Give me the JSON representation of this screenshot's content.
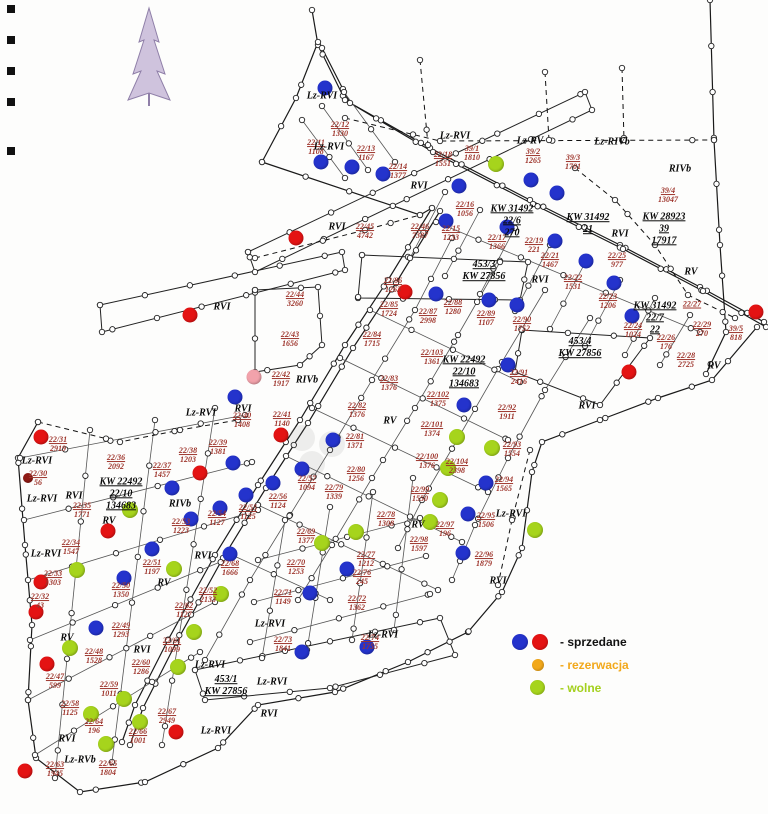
{
  "map": {
    "title": "plan sprzedazy dzialek",
    "dot_colors": {
      "blue": "#2433cc",
      "red": "#e41313",
      "darkred": "#8f1a14",
      "green": "#a6d41c",
      "orange": "#f2a81a",
      "pink": "#f2a2ab"
    },
    "dot_sizes": {
      "blue": 15,
      "red": 15,
      "darkred": 10,
      "green": 16,
      "orange": 11,
      "pink": 15
    },
    "plots": [
      {
        "n": "22/11",
        "a": "1108",
        "x": 316,
        "y": 148
      },
      {
        "n": "22/12",
        "a": "1330",
        "x": 340,
        "y": 130
      },
      {
        "n": "22/13",
        "a": "1167",
        "x": 366,
        "y": 154
      },
      {
        "n": "22/14",
        "a": "1377",
        "x": 398,
        "y": 172
      },
      {
        "n": "22/18",
        "a": "1551",
        "x": 443,
        "y": 160
      },
      {
        "n": "39/1",
        "a": "1810",
        "x": 472,
        "y": 154
      },
      {
        "n": "39/2",
        "a": "1265",
        "x": 533,
        "y": 157
      },
      {
        "n": "39/3",
        "a": "1701",
        "x": 573,
        "y": 163
      },
      {
        "n": "39/4",
        "a": "13047",
        "x": 668,
        "y": 196
      },
      {
        "n": "22/16",
        "a": "1056",
        "x": 465,
        "y": 210
      },
      {
        "n": "22/15",
        "a": "1233",
        "x": 451,
        "y": 234
      },
      {
        "n": "22/46",
        "a": "7387",
        "x": 420,
        "y": 232
      },
      {
        "n": "22/17",
        "a": "1366",
        "x": 497,
        "y": 243
      },
      {
        "n": "22/19",
        "a": "221",
        "x": 534,
        "y": 246
      },
      {
        "n": "22/21",
        "a": "1467",
        "x": 550,
        "y": 261
      },
      {
        "n": "22/22",
        "a": "1531",
        "x": 573,
        "y": 283
      },
      {
        "n": "22/25",
        "a": "977",
        "x": 617,
        "y": 261
      },
      {
        "n": "22/23",
        "a": "1206",
        "x": 608,
        "y": 302
      },
      {
        "n": "22/24",
        "a": "1024",
        "x": 633,
        "y": 331
      },
      {
        "n": "22/26",
        "a": "176",
        "x": 666,
        "y": 343
      },
      {
        "n": "22/27",
        "a": "",
        "x": 692,
        "y": 305
      },
      {
        "n": "22/29",
        "a": "270",
        "x": 702,
        "y": 330
      },
      {
        "n": "39/5",
        "a": "818",
        "x": 736,
        "y": 334
      },
      {
        "n": "22/28",
        "a": "2725",
        "x": 686,
        "y": 361
      },
      {
        "n": "22/45",
        "a": "4742",
        "x": 365,
        "y": 232
      },
      {
        "n": "22/44",
        "a": "3260",
        "x": 295,
        "y": 300
      },
      {
        "n": "22/43",
        "a": "1656",
        "x": 290,
        "y": 340
      },
      {
        "n": "22/42",
        "a": "1917",
        "x": 281,
        "y": 380
      },
      {
        "n": "22/41",
        "a": "1140",
        "x": 282,
        "y": 420
      },
      {
        "n": "22/40",
        "a": "1408",
        "x": 242,
        "y": 421
      },
      {
        "n": "22/39",
        "a": "1381",
        "x": 218,
        "y": 448
      },
      {
        "n": "22/38",
        "a": "1203",
        "x": 188,
        "y": 456
      },
      {
        "n": "22/37",
        "a": "1457",
        "x": 162,
        "y": 471
      },
      {
        "n": "22/36",
        "a": "2092",
        "x": 116,
        "y": 463
      },
      {
        "n": "22/31",
        "a": "2919",
        "x": 58,
        "y": 445
      },
      {
        "n": "22/30",
        "a": "56",
        "x": 38,
        "y": 479
      },
      {
        "n": "22/35",
        "a": "1771",
        "x": 82,
        "y": 511
      },
      {
        "n": "22/34",
        "a": "1547",
        "x": 71,
        "y": 548
      },
      {
        "n": "22/33",
        "a": "1303",
        "x": 53,
        "y": 579
      },
      {
        "n": "22/32",
        "a": "43",
        "x": 40,
        "y": 602
      },
      {
        "n": "22/51",
        "a": "1197",
        "x": 152,
        "y": 568
      },
      {
        "n": "22/50",
        "a": "1350",
        "x": 121,
        "y": 591
      },
      {
        "n": "22/68",
        "a": "1666",
        "x": 230,
        "y": 569
      },
      {
        "n": "22/52",
        "a": "2133",
        "x": 208,
        "y": 596
      },
      {
        "n": "22/62",
        "a": "1127",
        "x": 184,
        "y": 611
      },
      {
        "n": "22/49",
        "a": "1293",
        "x": 121,
        "y": 631
      },
      {
        "n": "22/61",
        "a": "1099",
        "x": 172,
        "y": 646
      },
      {
        "n": "22/48",
        "a": "1528",
        "x": 94,
        "y": 657
      },
      {
        "n": "22/60",
        "a": "1286",
        "x": 141,
        "y": 668
      },
      {
        "n": "22/47",
        "a": "599",
        "x": 55,
        "y": 682
      },
      {
        "n": "22/59",
        "a": "1011",
        "x": 109,
        "y": 690
      },
      {
        "n": "22/58",
        "a": "1125",
        "x": 70,
        "y": 709
      },
      {
        "n": "22/64",
        "a": "196",
        "x": 94,
        "y": 727
      },
      {
        "n": "22/63",
        "a": "1945",
        "x": 55,
        "y": 770
      },
      {
        "n": "22/65",
        "a": "1804",
        "x": 108,
        "y": 769
      },
      {
        "n": "22/66",
        "a": "1001",
        "x": 138,
        "y": 737
      },
      {
        "n": "22/67",
        "a": "2949",
        "x": 167,
        "y": 717
      },
      {
        "n": "22/57",
        "a": "1094",
        "x": 307,
        "y": 484
      },
      {
        "n": "22/56",
        "a": "1124",
        "x": 278,
        "y": 502
      },
      {
        "n": "22/55",
        "a": "1125",
        "x": 248,
        "y": 513
      },
      {
        "n": "22/54",
        "a": "1127",
        "x": 217,
        "y": 519
      },
      {
        "n": "22/53",
        "a": "1223",
        "x": 181,
        "y": 527
      },
      {
        "n": "22/81",
        "a": "1371",
        "x": 355,
        "y": 442
      },
      {
        "n": "22/80",
        "a": "1256",
        "x": 356,
        "y": 475
      },
      {
        "n": "22/79",
        "a": "1339",
        "x": 334,
        "y": 493
      },
      {
        "n": "22/78",
        "a": "1308",
        "x": 386,
        "y": 520
      },
      {
        "n": "22/69",
        "a": "1377",
        "x": 306,
        "y": 537
      },
      {
        "n": "22/70",
        "a": "1253",
        "x": 296,
        "y": 568
      },
      {
        "n": "22/77",
        "a": "1212",
        "x": 366,
        "y": 560
      },
      {
        "n": "22/76",
        "a": "245",
        "x": 362,
        "y": 578
      },
      {
        "n": "22/71",
        "a": "1149",
        "x": 283,
        "y": 598
      },
      {
        "n": "22/72",
        "a": "1362",
        "x": 357,
        "y": 604
      },
      {
        "n": "22/73",
        "a": "1841",
        "x": 283,
        "y": 645
      },
      {
        "n": "22/74",
        "a": "1755",
        "x": 370,
        "y": 643
      },
      {
        "n": "22/98",
        "a": "1597",
        "x": 419,
        "y": 545
      },
      {
        "n": "22/99",
        "a": "1550",
        "x": 420,
        "y": 495
      },
      {
        "n": "22/100",
        "a": "1376",
        "x": 427,
        "y": 462
      },
      {
        "n": "22/101",
        "a": "1374",
        "x": 432,
        "y": 430
      },
      {
        "n": "22/102",
        "a": "1375",
        "x": 438,
        "y": 400
      },
      {
        "n": "22/103",
        "a": "1361",
        "x": 432,
        "y": 358
      },
      {
        "n": "22/104",
        "a": "2398",
        "x": 457,
        "y": 467
      },
      {
        "n": "22/97",
        "a": "196",
        "x": 445,
        "y": 530
      },
      {
        "n": "22/91",
        "a": "2416",
        "x": 519,
        "y": 378
      },
      {
        "n": "22/92",
        "a": "1911",
        "x": 507,
        "y": 413
      },
      {
        "n": "22/93",
        "a": "1554",
        "x": 512,
        "y": 450
      },
      {
        "n": "22/94",
        "a": "1565",
        "x": 504,
        "y": 485
      },
      {
        "n": "22/95",
        "a": "1506",
        "x": 486,
        "y": 521
      },
      {
        "n": "22/96",
        "a": "1879",
        "x": 484,
        "y": 560
      },
      {
        "n": "22/90",
        "a": "1752",
        "x": 522,
        "y": 325
      },
      {
        "n": "22/89",
        "a": "1107",
        "x": 486,
        "y": 319
      },
      {
        "n": "22/88",
        "a": "1280",
        "x": 453,
        "y": 308
      },
      {
        "n": "22/87",
        "a": "2998",
        "x": 428,
        "y": 317
      },
      {
        "n": "22/86",
        "a": "1263",
        "x": 393,
        "y": 286
      },
      {
        "n": "22/85",
        "a": "1724",
        "x": 389,
        "y": 310
      },
      {
        "n": "22/84",
        "a": "1715",
        "x": 372,
        "y": 340
      },
      {
        "n": "22/83",
        "a": "1376",
        "x": 389,
        "y": 384
      },
      {
        "n": "22/82",
        "a": "1376",
        "x": 357,
        "y": 411
      }
    ],
    "region_labels": [
      {
        "t": "Lz-RVI",
        "x": 322,
        "y": 96
      },
      {
        "t": "Lz-RVI",
        "x": 329,
        "y": 147
      },
      {
        "t": "Lz-RVI",
        "x": 455,
        "y": 136
      },
      {
        "t": "Lz-RV",
        "x": 530,
        "y": 141
      },
      {
        "t": "Lz-RIVb",
        "x": 612,
        "y": 142
      },
      {
        "t": "RIVb",
        "x": 680,
        "y": 169
      },
      {
        "t": "RVI",
        "x": 419,
        "y": 186
      },
      {
        "t": "RVI",
        "x": 620,
        "y": 234
      },
      {
        "t": "RVI",
        "x": 337,
        "y": 227
      },
      {
        "t": "RVI",
        "x": 222,
        "y": 307
      },
      {
        "t": "RVI",
        "x": 540,
        "y": 280
      },
      {
        "t": "RV",
        "x": 691,
        "y": 272
      },
      {
        "t": "RV",
        "x": 714,
        "y": 366
      },
      {
        "t": "RVI",
        "x": 587,
        "y": 406
      },
      {
        "t": "RV",
        "x": 390,
        "y": 421
      },
      {
        "t": "RIVb",
        "x": 307,
        "y": 380
      },
      {
        "t": "RVI",
        "x": 243,
        "y": 409
      },
      {
        "t": "Lz-RVI",
        "x": 201,
        "y": 413
      },
      {
        "t": "Lz-RVI",
        "x": 37,
        "y": 461
      },
      {
        "t": "Lz-RVI",
        "x": 42,
        "y": 499
      },
      {
        "t": "Lz-RVI",
        "x": 46,
        "y": 554
      },
      {
        "t": "RIVb",
        "x": 180,
        "y": 504
      },
      {
        "t": "RVI",
        "x": 74,
        "y": 496
      },
      {
        "t": "RV",
        "x": 109,
        "y": 521
      },
      {
        "t": "RV",
        "x": 418,
        "y": 525
      },
      {
        "t": "RVI",
        "x": 203,
        "y": 556
      },
      {
        "t": "RV",
        "x": 164,
        "y": 583
      },
      {
        "t": "RV",
        "x": 67,
        "y": 638
      },
      {
        "t": "RVI",
        "x": 142,
        "y": 650
      },
      {
        "t": "Lz-RVI",
        "x": 210,
        "y": 665
      },
      {
        "t": "RVI",
        "x": 269,
        "y": 714
      },
      {
        "t": "Lz-RVI",
        "x": 216,
        "y": 731
      },
      {
        "t": "RVI",
        "x": 67,
        "y": 739
      },
      {
        "t": "Lz-RVb",
        "x": 80,
        "y": 760
      },
      {
        "t": "Lz-RVI",
        "x": 272,
        "y": 682
      },
      {
        "t": "Lz-RVI",
        "x": 270,
        "y": 624
      },
      {
        "t": "Lz-RVI",
        "x": 383,
        "y": 635
      },
      {
        "t": "Lz-RVI",
        "x": 511,
        "y": 514
      },
      {
        "t": "RVI",
        "x": 498,
        "y": 581
      }
    ],
    "kw_labels": [
      {
        "lines": [
          "KW 31492",
          "22/6",
          "270"
        ],
        "x": 512,
        "y": 221
      },
      {
        "lines": [
          "KW 31492",
          "21"
        ],
        "x": 588,
        "y": 224
      },
      {
        "lines": [
          "KW 28923",
          "39",
          "17917"
        ],
        "x": 664,
        "y": 229
      },
      {
        "lines": [
          "453/3",
          "KW 27856"
        ],
        "x": 484,
        "y": 271
      },
      {
        "lines": [
          "KW 31492",
          "22/7",
          "22"
        ],
        "x": 655,
        "y": 318
      },
      {
        "lines": [
          "453/4",
          "KW 27856"
        ],
        "x": 580,
        "y": 348
      },
      {
        "lines": [
          "KW 22492",
          "22/10",
          "134683"
        ],
        "x": 464,
        "y": 372
      },
      {
        "lines": [
          "KW 22492",
          "22/10",
          "134683"
        ],
        "x": 121,
        "y": 494
      },
      {
        "lines": [
          "453/1",
          "KW 27856"
        ],
        "x": 226,
        "y": 686
      }
    ],
    "dots": [
      {
        "c": "blue",
        "x": 325,
        "y": 88
      },
      {
        "c": "blue",
        "x": 321,
        "y": 162
      },
      {
        "c": "blue",
        "x": 352,
        "y": 167
      },
      {
        "c": "blue",
        "x": 383,
        "y": 174
      },
      {
        "c": "blue",
        "x": 459,
        "y": 186
      },
      {
        "c": "blue",
        "x": 531,
        "y": 180
      },
      {
        "c": "blue",
        "x": 557,
        "y": 193
      },
      {
        "c": "blue",
        "x": 446,
        "y": 221
      },
      {
        "c": "blue",
        "x": 507,
        "y": 227
      },
      {
        "c": "blue",
        "x": 555,
        "y": 241
      },
      {
        "c": "blue",
        "x": 586,
        "y": 261
      },
      {
        "c": "blue",
        "x": 614,
        "y": 283
      },
      {
        "c": "blue",
        "x": 632,
        "y": 316
      },
      {
        "c": "blue",
        "x": 436,
        "y": 294
      },
      {
        "c": "blue",
        "x": 489,
        "y": 300
      },
      {
        "c": "blue",
        "x": 517,
        "y": 305
      },
      {
        "c": "blue",
        "x": 508,
        "y": 365
      },
      {
        "c": "blue",
        "x": 464,
        "y": 405
      },
      {
        "c": "blue",
        "x": 235,
        "y": 397
      },
      {
        "c": "blue",
        "x": 333,
        "y": 440
      },
      {
        "c": "blue",
        "x": 302,
        "y": 469
      },
      {
        "c": "blue",
        "x": 273,
        "y": 483
      },
      {
        "c": "blue",
        "x": 233,
        "y": 463
      },
      {
        "c": "blue",
        "x": 246,
        "y": 495
      },
      {
        "c": "blue",
        "x": 220,
        "y": 508
      },
      {
        "c": "blue",
        "x": 191,
        "y": 519
      },
      {
        "c": "blue",
        "x": 172,
        "y": 488
      },
      {
        "c": "blue",
        "x": 152,
        "y": 549
      },
      {
        "c": "blue",
        "x": 230,
        "y": 554
      },
      {
        "c": "blue",
        "x": 124,
        "y": 578
      },
      {
        "c": "blue",
        "x": 96,
        "y": 628
      },
      {
        "c": "blue",
        "x": 310,
        "y": 593
      },
      {
        "c": "blue",
        "x": 347,
        "y": 569
      },
      {
        "c": "blue",
        "x": 367,
        "y": 647
      },
      {
        "c": "blue",
        "x": 302,
        "y": 652
      },
      {
        "c": "blue",
        "x": 486,
        "y": 483
      },
      {
        "c": "blue",
        "x": 468,
        "y": 514
      },
      {
        "c": "blue",
        "x": 463,
        "y": 553
      },
      {
        "c": "red",
        "x": 296,
        "y": 238
      },
      {
        "c": "red",
        "x": 190,
        "y": 315
      },
      {
        "c": "red",
        "x": 405,
        "y": 292
      },
      {
        "c": "red",
        "x": 756,
        "y": 312
      },
      {
        "c": "red",
        "x": 629,
        "y": 372
      },
      {
        "c": "red",
        "x": 281,
        "y": 435
      },
      {
        "c": "red",
        "x": 41,
        "y": 437
      },
      {
        "c": "red",
        "x": 200,
        "y": 473
      },
      {
        "c": "red",
        "x": 108,
        "y": 531
      },
      {
        "c": "red",
        "x": 41,
        "y": 582
      },
      {
        "c": "red",
        "x": 36,
        "y": 612
      },
      {
        "c": "red",
        "x": 47,
        "y": 664
      },
      {
        "c": "red",
        "x": 25,
        "y": 771
      },
      {
        "c": "red",
        "x": 176,
        "y": 732
      },
      {
        "c": "darkred",
        "x": 28,
        "y": 478
      },
      {
        "c": "pink",
        "x": 254,
        "y": 377
      },
      {
        "c": "green",
        "x": 496,
        "y": 164
      },
      {
        "c": "green",
        "x": 457,
        "y": 437
      },
      {
        "c": "green",
        "x": 492,
        "y": 448
      },
      {
        "c": "green",
        "x": 448,
        "y": 468
      },
      {
        "c": "green",
        "x": 440,
        "y": 500
      },
      {
        "c": "green",
        "x": 430,
        "y": 522
      },
      {
        "c": "green",
        "x": 535,
        "y": 530
      },
      {
        "c": "green",
        "x": 356,
        "y": 532
      },
      {
        "c": "green",
        "x": 322,
        "y": 543
      },
      {
        "c": "green",
        "x": 174,
        "y": 569
      },
      {
        "c": "green",
        "x": 77,
        "y": 570
      },
      {
        "c": "green",
        "x": 130,
        "y": 510
      },
      {
        "c": "green",
        "x": 221,
        "y": 594
      },
      {
        "c": "green",
        "x": 194,
        "y": 632
      },
      {
        "c": "green",
        "x": 70,
        "y": 648
      },
      {
        "c": "green",
        "x": 178,
        "y": 667
      },
      {
        "c": "green",
        "x": 124,
        "y": 699
      },
      {
        "c": "green",
        "x": 140,
        "y": 722
      },
      {
        "c": "green",
        "x": 106,
        "y": 744
      },
      {
        "c": "green",
        "x": 91,
        "y": 714
      }
    ]
  },
  "legend": {
    "items": [
      {
        "label": "- sprzedane",
        "label_color": "#111111",
        "dots": [
          "blue",
          "red"
        ]
      },
      {
        "label": "- rezerwacja",
        "label_color": "#f2a81a",
        "dots": [
          "orange"
        ]
      },
      {
        "label": "- wolne",
        "label_color": "#a4d01e",
        "dots": [
          "green"
        ]
      }
    ]
  }
}
